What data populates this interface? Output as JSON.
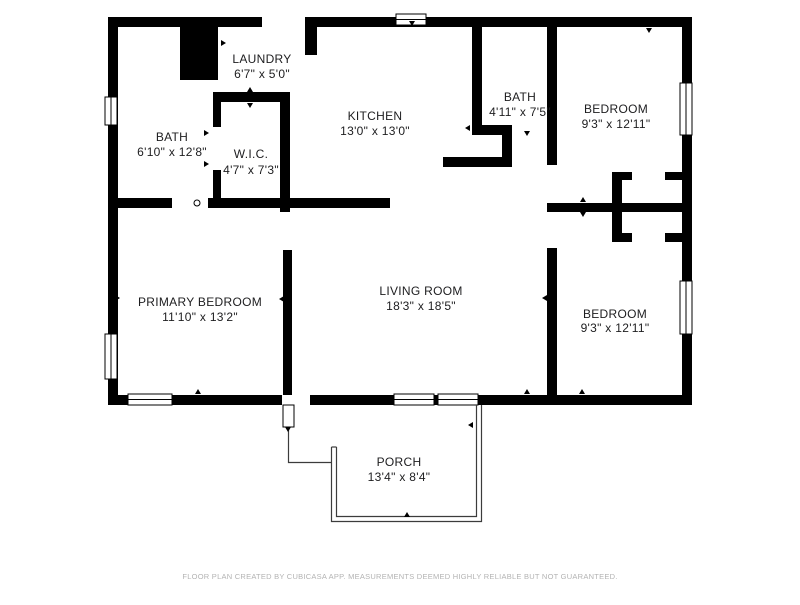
{
  "footer": {
    "text": "FLOOR PLAN CREATED BY CUBICASA APP. MEASUREMENTS DEEMED HIGHLY RELIABLE BUT NOT GUARANTEED."
  },
  "floorplan": {
    "wall_color": "#000000",
    "label_color": "#1d1d1f",
    "footer_color": "#b3b3b3",
    "porch_line_color": "#3c3c3c",
    "rooms": [
      {
        "id": "bath-1",
        "name": "BATH",
        "dims": "6'10\" x 12'8\"",
        "cx": 172,
        "name_y": 141,
        "dims_y": 156
      },
      {
        "id": "laundry",
        "name": "LAUNDRY",
        "dims": "6'7\" x 5'0\"",
        "cx": 262,
        "name_y": 63,
        "dims_y": 78
      },
      {
        "id": "wic",
        "name": "W.I.C.",
        "dims": "4'7\" x 7'3\"",
        "cx": 251,
        "name_y": 158,
        "dims_y": 174
      },
      {
        "id": "kitchen",
        "name": "KITCHEN",
        "dims": "13'0\" x 13'0\"",
        "cx": 375,
        "name_y": 120,
        "dims_y": 135
      },
      {
        "id": "bath-2",
        "name": "BATH",
        "dims": "4'11\" x 7'5\"",
        "cx": 520,
        "name_y": 101,
        "dims_y": 116
      },
      {
        "id": "bedroom-top",
        "name": "BEDROOM",
        "dims": "9'3\" x 12'11\"",
        "cx": 616,
        "name_y": 113,
        "dims_y": 128
      },
      {
        "id": "primary-bedroom",
        "name": "PRIMARY BEDROOM",
        "dims": "11'10\" x 13'2\"",
        "cx": 200,
        "name_y": 306,
        "dims_y": 321
      },
      {
        "id": "living-room",
        "name": "LIVING ROOM",
        "dims": "18'3\" x 18'5\"",
        "cx": 421,
        "name_y": 295,
        "dims_y": 310
      },
      {
        "id": "bedroom-bottom",
        "name": "BEDROOM",
        "dims": "9'3\" x 12'11\"",
        "cx": 615,
        "name_y": 318,
        "dims_y": 332
      },
      {
        "id": "porch",
        "name": "PORCH",
        "dims": "13'4\" x 8'4\"",
        "cx": 399,
        "name_y": 466,
        "dims_y": 481
      }
    ],
    "walls": [
      {
        "id": "ext-top-left",
        "x": 108,
        "y": 17,
        "w": 154,
        "h": 10
      },
      {
        "id": "ext-top-right",
        "x": 305,
        "y": 17,
        "w": 387,
        "h": 10
      },
      {
        "id": "ext-left",
        "x": 108,
        "y": 17,
        "w": 10,
        "h": 388
      },
      {
        "id": "ext-right",
        "x": 682,
        "y": 17,
        "w": 10,
        "h": 388
      },
      {
        "id": "ext-bottom-left",
        "x": 108,
        "y": 395,
        "w": 174,
        "h": 10
      },
      {
        "id": "ext-bottom-right",
        "x": 310,
        "y": 395,
        "w": 382,
        "h": 10
      },
      {
        "id": "chimney-block",
        "x": 180,
        "y": 17,
        "w": 38,
        "h": 63
      },
      {
        "id": "laundry-stub",
        "x": 305,
        "y": 17,
        "w": 12,
        "h": 38
      },
      {
        "id": "wic-left-top",
        "x": 213,
        "y": 92,
        "w": 8,
        "h": 35
      },
      {
        "id": "wic-left-bottom",
        "x": 213,
        "y": 170,
        "w": 8,
        "h": 38
      },
      {
        "id": "wic-top",
        "x": 213,
        "y": 92,
        "w": 77,
        "h": 10
      },
      {
        "id": "wic-right",
        "x": 280,
        "y": 92,
        "w": 10,
        "h": 120
      },
      {
        "id": "mid-wall-left",
        "x": 118,
        "y": 198,
        "w": 54,
        "h": 10
      },
      {
        "id": "mid-wall-center",
        "x": 208,
        "y": 198,
        "w": 182,
        "h": 10
      },
      {
        "id": "primary-living",
        "x": 283,
        "y": 250,
        "w": 9,
        "h": 145
      },
      {
        "id": "kitchen-right",
        "x": 472,
        "y": 27,
        "w": 10,
        "h": 103
      },
      {
        "id": "bath2-bottom",
        "x": 472,
        "y": 125,
        "w": 40,
        "h": 10
      },
      {
        "id": "kitchen-jog-v",
        "x": 502,
        "y": 125,
        "w": 10,
        "h": 42
      },
      {
        "id": "kitchen-jog-h",
        "x": 443,
        "y": 157,
        "w": 69,
        "h": 10
      },
      {
        "id": "divider-top",
        "x": 547,
        "y": 27,
        "w": 10,
        "h": 138
      },
      {
        "id": "divider-junction",
        "x": 547,
        "y": 203,
        "w": 10,
        "h": 9
      },
      {
        "id": "divider-bottom",
        "x": 547,
        "y": 248,
        "w": 10,
        "h": 147
      },
      {
        "id": "hall-bedroom-wall",
        "x": 557,
        "y": 203,
        "w": 135,
        "h": 9
      },
      {
        "id": "closet-mid-wall",
        "x": 612,
        "y": 172,
        "w": 10,
        "h": 70
      },
      {
        "id": "closet-top-left",
        "x": 622,
        "y": 172,
        "w": 10,
        "h": 8
      },
      {
        "id": "closet-top-right",
        "x": 665,
        "y": 172,
        "w": 17,
        "h": 8
      },
      {
        "id": "closet-bot-left",
        "x": 622,
        "y": 233,
        "w": 10,
        "h": 9
      },
      {
        "id": "closet-bot-right",
        "x": 665,
        "y": 233,
        "w": 17,
        "h": 9
      }
    ],
    "windows": [
      {
        "id": "win-top-kitchen",
        "x": 396,
        "y": 14,
        "w": 30,
        "h": 11,
        "orient": "h"
      },
      {
        "id": "win-left-bath",
        "x": 105,
        "y": 97,
        "w": 12,
        "h": 28,
        "orient": "v"
      },
      {
        "id": "win-left-primary",
        "x": 105,
        "y": 334,
        "w": 12,
        "h": 45,
        "orient": "v"
      },
      {
        "id": "win-right-bed-top",
        "x": 680,
        "y": 83,
        "w": 12,
        "h": 52,
        "orient": "v"
      },
      {
        "id": "win-right-bed-bot",
        "x": 680,
        "y": 281,
        "w": 12,
        "h": 53,
        "orient": "v"
      },
      {
        "id": "win-bottom-primary",
        "x": 128,
        "y": 394,
        "w": 44,
        "h": 11,
        "orient": "h"
      },
      {
        "id": "win-bottom-living1",
        "x": 394,
        "y": 394,
        "w": 40,
        "h": 11,
        "orient": "h"
      },
      {
        "id": "win-bottom-living2",
        "x": 438,
        "y": 394,
        "w": 40,
        "h": 11,
        "orient": "h"
      }
    ],
    "door_leaf": {
      "x": 283,
      "y": 405,
      "w": 11,
      "h": 22
    },
    "porch": {
      "outer": "M331.5,447 L331.5,521.5 L481.5,521.5 L481.5,405",
      "inner": "M336.5,447 L336.5,516.5 L476.5,516.5 L476.5,405",
      "cap": "M331.5,447 L336.5,447",
      "step": "M288.5,427 L288.5,462.5 L331.5,462.5"
    },
    "door_markers": [
      {
        "x": 150,
        "y": 24,
        "d": "down"
      },
      {
        "x": 257,
        "y": 24,
        "d": "down"
      },
      {
        "x": 412,
        "y": 24,
        "d": "down"
      },
      {
        "x": 510,
        "y": 24,
        "d": "down"
      },
      {
        "x": 649,
        "y": 31,
        "d": "down"
      },
      {
        "x": 224,
        "y": 43,
        "d": "right"
      },
      {
        "x": 310,
        "y": 41,
        "d": "left"
      },
      {
        "x": 250,
        "y": 89,
        "d": "up"
      },
      {
        "x": 250,
        "y": 106,
        "d": "down"
      },
      {
        "x": 207,
        "y": 133,
        "d": "right"
      },
      {
        "x": 207,
        "y": 164,
        "d": "right"
      },
      {
        "x": 467,
        "y": 128,
        "d": "left"
      },
      {
        "x": 527,
        "y": 134,
        "d": "down"
      },
      {
        "x": 551,
        "y": 99,
        "d": "left"
      },
      {
        "x": 684,
        "y": 60,
        "d": "left"
      },
      {
        "x": 118,
        "y": 298,
        "d": "right"
      },
      {
        "x": 281,
        "y": 299,
        "d": "left"
      },
      {
        "x": 544,
        "y": 298,
        "d": "left"
      },
      {
        "x": 555,
        "y": 317,
        "d": "right"
      },
      {
        "x": 583,
        "y": 199,
        "d": "up"
      },
      {
        "x": 583,
        "y": 215,
        "d": "down"
      },
      {
        "x": 198,
        "y": 391,
        "d": "up"
      },
      {
        "x": 527,
        "y": 391,
        "d": "up"
      },
      {
        "x": 582,
        "y": 391,
        "d": "up"
      },
      {
        "x": 470,
        "y": 425,
        "d": "left"
      },
      {
        "x": 407,
        "y": 514,
        "d": "up"
      },
      {
        "x": 288,
        "y": 430,
        "d": "down"
      }
    ],
    "circle_marker": {
      "x": 197,
      "y": 203,
      "r": 3
    }
  }
}
